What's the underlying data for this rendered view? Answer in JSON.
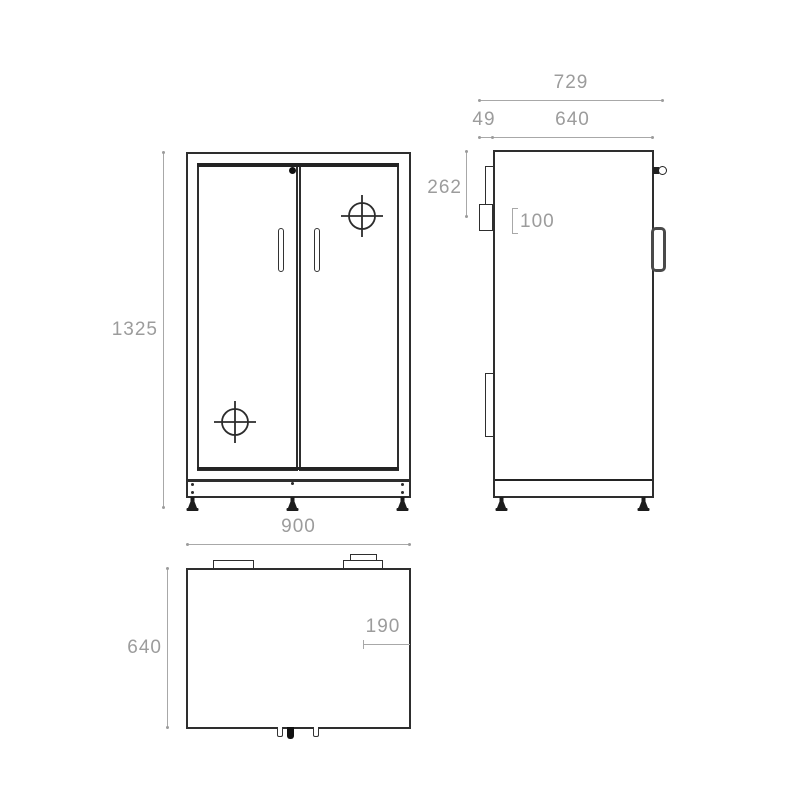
{
  "drawing_title": "cabinet-three-view-technical-drawing",
  "views": {
    "front": {
      "height_mm": "1325",
      "width_mm": "900"
    },
    "side": {
      "total_depth_mm": "729",
      "back_offset_mm": "49",
      "body_depth_mm": "640",
      "upper_section_mm": "262",
      "bracket_height_mm": "100"
    },
    "top": {
      "depth_mm": "640",
      "corner_inset_mm": "190"
    }
  },
  "colors": {
    "outline": "#2e2e2e",
    "dimension": "#9c9c9c",
    "background": "#ffffff",
    "solid_fill": "#1c1c1c"
  }
}
